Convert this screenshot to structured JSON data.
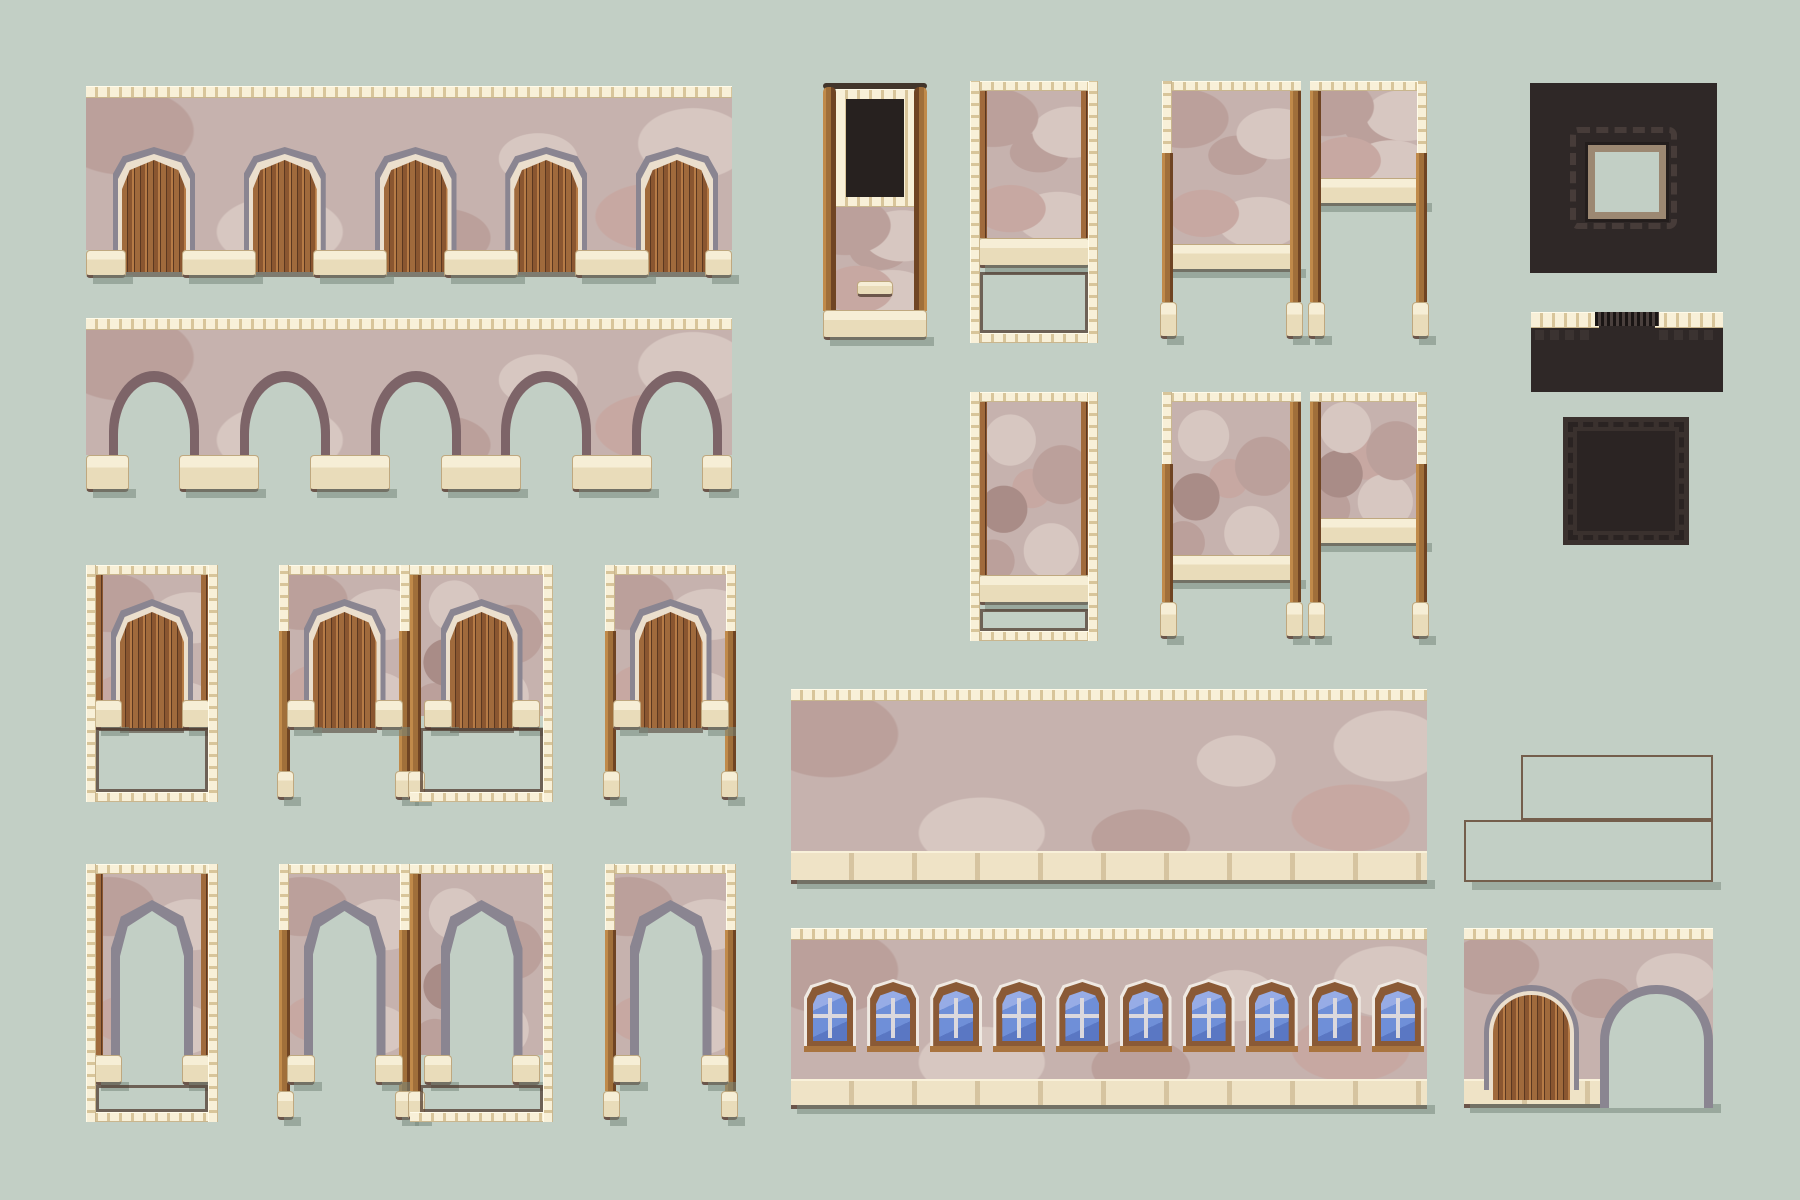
{
  "canvas": {
    "w": 1800,
    "h": 1200
  },
  "palette": {
    "bg": "#c2cfc5",
    "cream_l": "#f8f0d8",
    "cream_t": "#d8c59a",
    "trim_cream": "#ebdfcd",
    "sill": "#ece0c3",
    "line_dark": "#5f4a3c",
    "stone": "#c6b2ae",
    "stone_l": "#d7c7c1",
    "stone_m": "#bba09b",
    "stone_d": "#a98c87",
    "stone_p": "#c7a8a2",
    "arch_gray": "#8a8591",
    "arch_gray_d": "#6f6b78",
    "arch_mauve": "#7d6468",
    "wood1": "#a06a3c",
    "wood2": "#8a5630",
    "wood_line": "#5c3820",
    "wood_hi": "#b67b46",
    "post1": "#c08a4a",
    "post2": "#a06f3a",
    "post3": "#6f4423",
    "dark1": "#2f2827",
    "dark2": "#3b3331",
    "dark3": "#473c39",
    "dark_tan": "#9c8872",
    "brick": "#a08265",
    "brick_hi": "#b59677",
    "brick_mo": "#745e4c",
    "win_fr": "#8a5a36",
    "win_fr_hi": "#a9743f",
    "glass1": "#97ace6",
    "glass2": "#6f8fd8",
    "glass3": "#5a77c3",
    "mullion": "#dbd8dd"
  },
  "tiles": [
    {
      "type": "wall_doors",
      "name": "arcade-wall-with-doors",
      "x": 86,
      "y": 86,
      "w": 646,
      "cornice_h": 12,
      "stone_h": 164,
      "doors": 5,
      "first_cx": 68,
      "pitch": 130.75,
      "door_w": 64,
      "door_top": 74,
      "door_bottom": 186,
      "sill_h": 28
    },
    {
      "type": "bridge",
      "name": "aqueduct-arch-bridge",
      "x": 86,
      "y": 318,
      "w": 646,
      "cornice_h": 12,
      "stone_h": 137,
      "arches": 5,
      "first_cx": 68,
      "pitch": 130.75,
      "arch_w": 72,
      "arch_top": 64,
      "foot_h": 37
    },
    {
      "type": "panel",
      "name": "door-cell-framed",
      "x": 86,
      "y": 565,
      "w": 132,
      "h": 237,
      "frame": {
        "top": true,
        "bottom": true,
        "left": "full",
        "right": "full"
      },
      "trims": true,
      "stone_bottom": 163,
      "opening": {
        "kind": "door",
        "w": 64,
        "top": 47,
        "bottom": 163,
        "sills": true
      },
      "open_area": [
        163,
        227
      ]
    },
    {
      "type": "panel",
      "name": "door-cell-posts",
      "x": 279,
      "y": 565,
      "w": 131,
      "h": 237,
      "frame": {
        "top": true,
        "left": "stub",
        "right": "stub"
      },
      "posts": {
        "left": true,
        "right": true,
        "from": 66,
        "feet_y": 206
      },
      "stone_bottom": 151,
      "opening": {
        "kind": "door",
        "w": 64,
        "top": 47,
        "bottom": 163,
        "sills": true
      }
    },
    {
      "type": "panel",
      "name": "door-cell-cobble",
      "x": 410,
      "y": 565,
      "w": 143,
      "h": 237,
      "variant": "cobble",
      "frame": {
        "top": true,
        "bottom": true,
        "right": "full"
      },
      "posts": {
        "left": true,
        "from": 66,
        "feet_y": 206
      },
      "stone_bottom": 151,
      "opening": {
        "kind": "door",
        "w": 64,
        "top": 47,
        "bottom": 163,
        "sills": true
      },
      "open_area": [
        163,
        227
      ]
    },
    {
      "type": "panel",
      "name": "door-cell-posts-2",
      "x": 605,
      "y": 565,
      "w": 131,
      "h": 237,
      "frame": {
        "top": true,
        "left": "stub",
        "right": "stub"
      },
      "posts": {
        "left": true,
        "right": true,
        "from": 66,
        "feet_y": 206
      },
      "stone_bottom": 151,
      "opening": {
        "kind": "door",
        "w": 64,
        "top": 47,
        "bottom": 163,
        "sills": true
      }
    },
    {
      "type": "panel",
      "name": "arch-cell-framed",
      "x": 86,
      "y": 864,
      "w": 132,
      "h": 258,
      "frame": {
        "top": true,
        "bottom": true,
        "left": "full",
        "right": "full"
      },
      "trims": true,
      "stone_bottom": 191,
      "opening": {
        "kind": "arch",
        "w": 64,
        "top": 47,
        "bottom": 221,
        "sills": true,
        "sill_y": 191
      },
      "open_area": [
        221,
        248
      ]
    },
    {
      "type": "panel",
      "name": "arch-cell-posts",
      "x": 279,
      "y": 864,
      "w": 131,
      "h": 258,
      "frame": {
        "top": true,
        "left": "stub",
        "right": "stub"
      },
      "posts": {
        "left": true,
        "right": true,
        "from": 66,
        "feet_y": 227
      },
      "stone_bottom": 191,
      "opening": {
        "kind": "arch",
        "w": 64,
        "top": 47,
        "bottom": 221,
        "sills": true,
        "sill_y": 191
      }
    },
    {
      "type": "panel",
      "name": "arch-cell-cobble",
      "x": 410,
      "y": 864,
      "w": 143,
      "h": 258,
      "variant": "cobble",
      "frame": {
        "top": true,
        "bottom": true,
        "right": "full"
      },
      "posts": {
        "left": true,
        "from": 66,
        "feet_y": 227
      },
      "stone_bottom": 191,
      "opening": {
        "kind": "arch",
        "w": 64,
        "top": 47,
        "bottom": 221,
        "sills": true,
        "sill_y": 191
      },
      "open_area": [
        221,
        248
      ]
    },
    {
      "type": "panel",
      "name": "arch-cell-posts-2",
      "x": 605,
      "y": 864,
      "w": 131,
      "h": 258,
      "frame": {
        "top": true,
        "left": "stub",
        "right": "stub"
      },
      "posts": {
        "left": true,
        "right": true,
        "from": 66,
        "feet_y": 227
      },
      "stone_bottom": 191,
      "opening": {
        "kind": "arch",
        "w": 64,
        "top": 47,
        "bottom": 221,
        "sills": true,
        "sill_y": 191
      }
    },
    {
      "type": "pillar",
      "name": "doorway-pillar",
      "x": 823,
      "y": 83,
      "w": 104,
      "h": 257,
      "hole": [
        23,
        16,
        58,
        98
      ]
    },
    {
      "type": "panel",
      "name": "open-cell-framed",
      "x": 970,
      "y": 81,
      "w": 128,
      "h": 262,
      "frame": {
        "top": true,
        "bottom": true,
        "left": "full",
        "right": "full"
      },
      "trims": true,
      "stone_bottom": 157,
      "ledge": true,
      "open_area": [
        191,
        252
      ]
    },
    {
      "type": "hpair",
      "name": "gate-pillars",
      "x": 1162,
      "y": 81,
      "h": 260,
      "stub_h": 72,
      "ledge_h": 28,
      "feet_y": 221,
      "left": {
        "x": 0,
        "w": 139,
        "stone_bottom": 163
      },
      "right": {
        "x": 148,
        "w": 117,
        "stone_bottom": 97
      }
    },
    {
      "type": "panel",
      "name": "open-cell-cobble",
      "x": 970,
      "y": 392,
      "w": 128,
      "h": 249,
      "variant": "cobble",
      "frame": {
        "top": true,
        "bottom": true,
        "left": "full",
        "right": "full"
      },
      "trims": true,
      "stone_bottom": 183,
      "ledge": true,
      "open_area": [
        217,
        239
      ]
    },
    {
      "type": "hpair",
      "name": "gate-pillars-cobble",
      "x": 1162,
      "y": 392,
      "h": 249,
      "variant": "cobble",
      "stub_h": 72,
      "ledge_h": 28,
      "feet_y": 210,
      "left": {
        "x": 0,
        "w": 139,
        "stone_bottom": 163
      },
      "right": {
        "x": 148,
        "w": 117,
        "stone_bottom": 126
      }
    },
    {
      "type": "dark_platform",
      "name": "dark-platform-with-hole",
      "x": 1530,
      "y": 83,
      "w": 187,
      "h": 190,
      "hole": [
        58,
        62,
        78,
        74
      ]
    },
    {
      "type": "dark_strip",
      "name": "dark-ledge-strip",
      "x": 1531,
      "y": 312,
      "w": 192,
      "h": 80
    },
    {
      "type": "dark_square",
      "name": "dark-stitched-pad",
      "x": 1563,
      "y": 417,
      "w": 126,
      "h": 128
    },
    {
      "type": "wide_wall",
      "name": "large-stone-wall",
      "x": 791,
      "y": 689,
      "w": 636,
      "h": 195,
      "base_h": 33,
      "windows": 0
    },
    {
      "type": "wide_wall",
      "name": "window-wall",
      "x": 791,
      "y": 928,
      "w": 636,
      "h": 181,
      "base_h": 30,
      "windows": 10,
      "win": {
        "first_cx": 39,
        "pitch": 63.1,
        "y": 54,
        "w": 46,
        "h": 64
      }
    },
    {
      "type": "steps",
      "name": "brick-steps",
      "lower": [
        1464,
        820,
        249,
        62
      ],
      "upper": [
        1521,
        755,
        192,
        65
      ]
    },
    {
      "type": "arch_building",
      "name": "door-and-arch-wall",
      "x": 1464,
      "y": 928,
      "w": 249,
      "h": 180
    }
  ]
}
